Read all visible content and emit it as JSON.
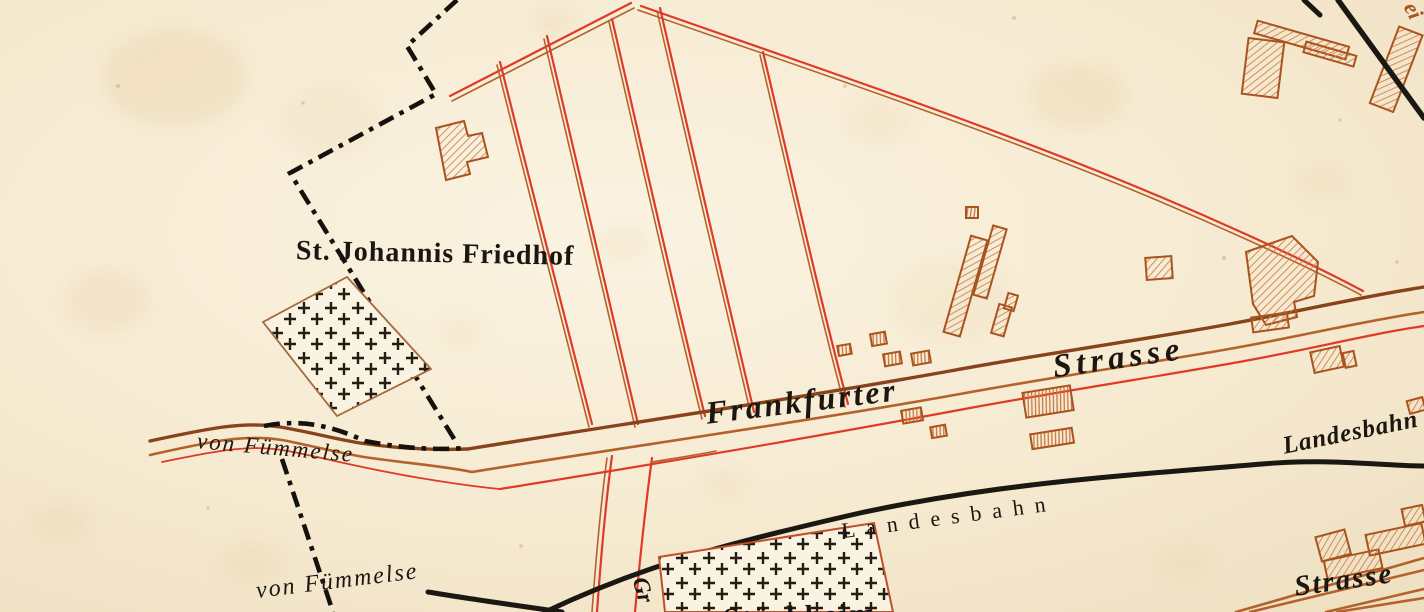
{
  "map": {
    "description": "Historical town plan fragment (Wolfenbüttel area) with cemetery, roads, planned streets, buildings and light railway",
    "labels": {
      "cemetery_name": "St. Johannis Friedhof",
      "frankfurter": "Frankfurter",
      "frankfurter_strasse": "Strasse",
      "von_fuemmelse_road": "von Fümmelse",
      "von_fuemmelse_rail": "von Fümmelse",
      "landesbahn_main": "Landesbahn",
      "landesbahn_right": "Landesbahn",
      "strasse_bottom": "Strasse",
      "gr_fragment": "Gr",
      "bottom_fragment": "Stöckheim",
      "corner_fragment": "ei"
    },
    "features": [
      {
        "name": "st-johannis-friedhof",
        "kind": "cemetery with cross symbols"
      },
      {
        "name": "south-cemetery",
        "kind": "cemetery with cross symbols, clipped at bottom edge"
      },
      {
        "name": "frankfurter-strasse",
        "kind": "main road, double dark-brown lines with red parallel"
      },
      {
        "name": "road-from-fuemmelse",
        "kind": "country road entering from left"
      },
      {
        "name": "planned-street-grid",
        "kind": "red double-line planned streets"
      },
      {
        "name": "landesbahn",
        "kind": "railway, thick black line"
      },
      {
        "name": "railway-to-fuemmelse",
        "kind": "railway branch at bottom left"
      },
      {
        "name": "railway-top-right",
        "kind": "railway, thick black line top right corner"
      },
      {
        "name": "city-boundary",
        "kind": "black dash-dot boundary line"
      },
      {
        "name": "buildings",
        "kind": "brown hatched building footprints"
      }
    ],
    "colors": {
      "paper": "#f6ead1",
      "paper_light": "#faf3e2",
      "paper_edge": "#eedfc0",
      "paper_stain": "#d3a056",
      "freckle": "#b97c3a",
      "road_red": "#df3a28",
      "road_brown": "#b4622c",
      "road_dark": "#87431b",
      "railway": "#1b1713",
      "boundary": "#15110d",
      "building": "#a9531f",
      "building_hatch": "#c9763f",
      "cemetery_outline": "#a46a3c",
      "cemetery2_outline": "#c04f2b",
      "cross": "#221c14",
      "label": "#1b1610",
      "label_brown": "#a9531f"
    }
  }
}
